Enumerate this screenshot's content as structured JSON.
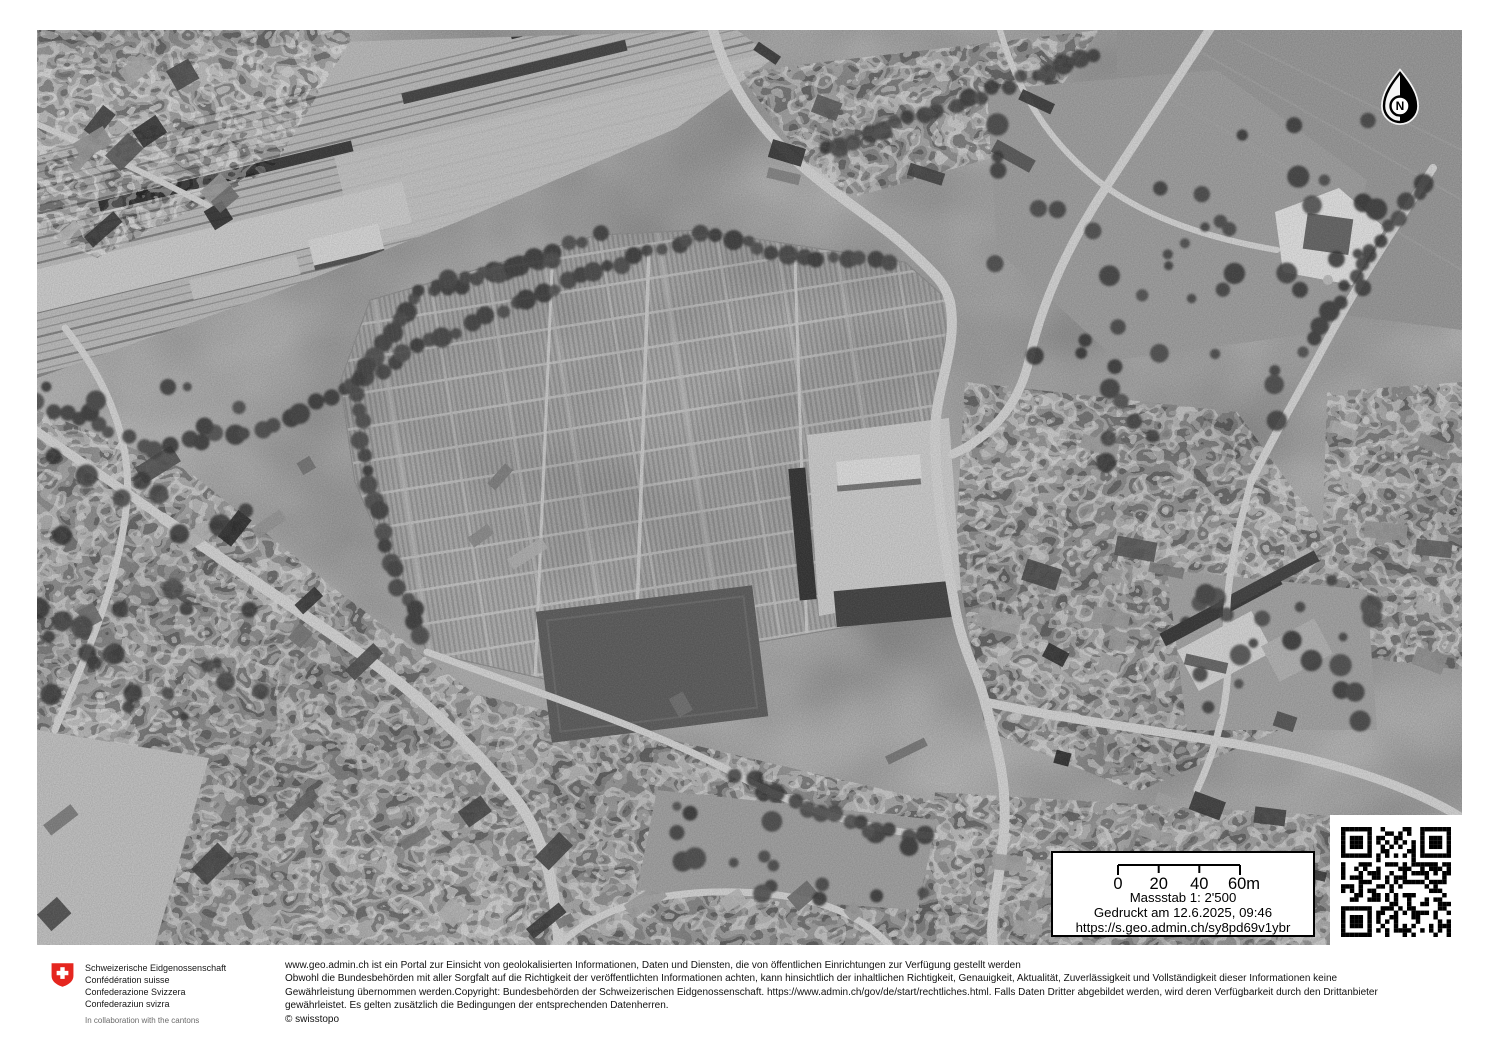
{
  "overlay": {
    "north_label": "N",
    "scale": {
      "ticks": [
        "0",
        "20",
        "40",
        "60m"
      ],
      "massstab": "Massstab 1: 2'500",
      "printed": "Gedruckt am 12.6.2025, 09:46",
      "url": "https://s.geo.admin.ch/sy8pd69v1ybr"
    }
  },
  "footer": {
    "coat_lines": [
      "Schweizerische Eidgenossenschaft",
      "Confédération suisse",
      "Confederazione Svizzera",
      "Confederaziun svizra"
    ],
    "collab": "In collaboration with the cantons",
    "disclaimer": [
      "www.geo.admin.ch ist ein Portal zur Einsicht von geolokalisierten Informationen, Daten und Diensten, die von öffentlichen Einrichtungen zur Verfügung gestellt werden",
      "Obwohl die Bundesbehörden mit aller Sorgfalt auf die Richtigkeit der veröffentlichten Informationen achten, kann hinsichtlich der inhaltlichen Richtigkeit, Genauigkeit, Aktualität, Zuverlässigkeit und Vollständigkeit dieser Informationen keine",
      "Gewährleistung übernommen werden.Copyright: Bundesbehörden der Schweizerischen Eidgenossenschaft. https://www.admin.ch/gov/de/start/rechtliches.html. Falls Daten Dritter abgebildet werden, wird deren Verfügbarkeit durch den Drittanbieter",
      "gewährleistet. Es gelten zusätzlich die Bedingungen der entsprechenden Datenherren."
    ],
    "copyright": "© swisstopo"
  },
  "colors": {
    "swiss_red": "#e5261f"
  }
}
